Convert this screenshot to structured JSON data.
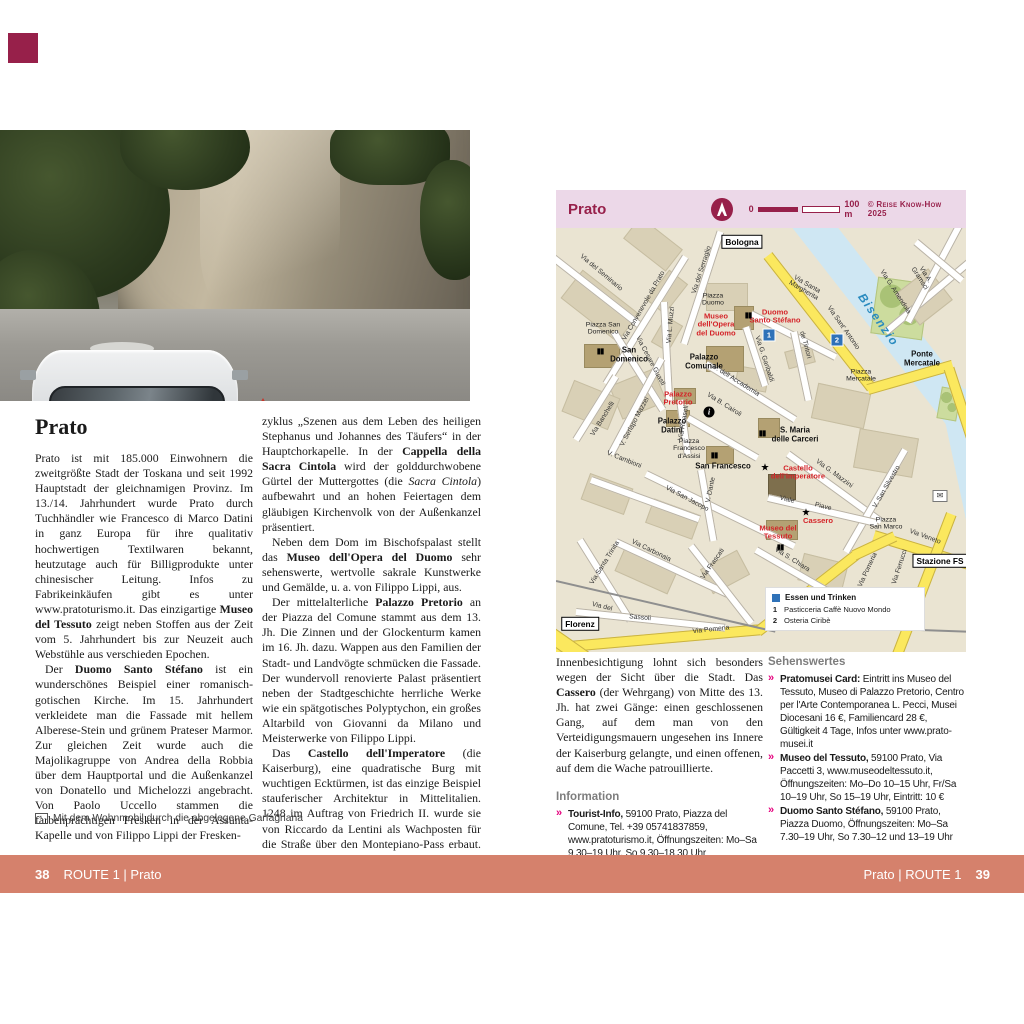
{
  "page_left": {
    "title": "Prato",
    "caption_icon_glyph": "↖",
    "caption": "Mit dem Wohnmobil durch die abgelegene Garfagnana",
    "photo": {
      "vehicle_brand": "HYMER"
    },
    "col1_p1": [
      {
        "t": "Prato ist mit 185.000 Einwohnern die zweitgrößte Stadt der Toskana und seit 1992 Hauptstadt der gleichnamigen Provinz. Im 13./14. Jahrhundert wurde Prato durch Tuchhändler wie Francesco di Marco Datini in ganz Europa für ihre qualitativ hochwertigen Textilwaren bekannt, heutzutage auch für Billigprodukte unter chinesischer Leitung. Infos zu Fabrikeinkäufen gibt es unter www.pratoturismo.it. Das einzigartige "
      },
      {
        "t": "Museo del Tessuto",
        "b": true
      },
      {
        "t": " zeigt neben Stoffen aus der Zeit vom 5. Jahrhundert bis zur Neuzeit auch Webstühle aus verschieden Epochen."
      }
    ],
    "col1_p2": [
      {
        "t": "Der "
      },
      {
        "t": "Duomo Santo Stéfano",
        "b": true
      },
      {
        "t": " ist ein wunderschönes Beispiel einer romanisch-gotischen Kirche. Im 15. Jahrhundert verkleidete man die Fassade mit hellem Alberese-Stein und grünem Prateser Marmor. Zur gleichen Zeit wurde auch die Majolikagruppe von Andrea della Robbia über dem Hauptportal und die Außenkanzel von Donatello und Michelozzi angebracht. Von Paolo Uccello stammen die farbenprächtigen Fresken in der Assunta-Kapelle und von Filippo Lippi der Fresken-"
      }
    ],
    "col2_p1": [
      {
        "t": "zyklus „Szenen aus dem Leben des heiligen Stephanus und Johannes des Täufers“ in der Hauptchorkapelle. In der "
      },
      {
        "t": "Cappella della Sacra Cintola",
        "b": true
      },
      {
        "t": " wird der golddurchwobene Gürtel der Muttergottes (die "
      },
      {
        "t": "Sacra Cintola",
        "i": true
      },
      {
        "t": ") aufbewahrt und an hohen Feiertagen dem gläubigen Kirchenvolk von der Außenkanzel präsentiert."
      }
    ],
    "col2_p2": [
      {
        "t": "Neben dem Dom im Bischofspalast stellt das "
      },
      {
        "t": "Museo dell'Opera del Duomo",
        "b": true
      },
      {
        "t": " sehr sehenswerte, wertvolle sakrale Kunstwerke und Gemälde, u. a. von Filippo Lippi, aus."
      }
    ],
    "col2_p3": [
      {
        "t": "Der mittelalterliche "
      },
      {
        "t": "Palazzo Pretorio",
        "b": true
      },
      {
        "t": " an der Piazza del Comune stammt aus dem 13. Jh. Die Zinnen und der Glockenturm kamen im 16. Jh. dazu. Wappen aus den Familien der Stadt- und Landvögte schmücken die Fassade. Der wundervoll renovierte Palast präsentiert neben der Stadtgeschichte herrliche Werke wie ein spätgotisches Polyptychon, ein großes Altarbild von Giovanni da Milano und Meisterwerke von Filippo Lippi."
      }
    ],
    "col2_p4": [
      {
        "t": "Das "
      },
      {
        "t": "Castello dell'Imperatore",
        "b": true
      },
      {
        "t": " (die Kaiserburg), eine quadratische Burg mit wuchtigen Ecktürmen, ist das einzige Beispiel stauferischer Architektur in Mittelitalien. 1248 im Auftrag von Friedrich II. wurde sie von Riccardo da Lentini als Wachposten für die Straße über den Montepiano-Pass erbaut. Eine"
      }
    ]
  },
  "map": {
    "header": {
      "title": "Prato",
      "scale_zero": "0",
      "scale_label": "100 m",
      "copyright": "© Reise Know-How 2025"
    },
    "legend": {
      "title": "Essen und Trinken",
      "items": [
        {
          "num": "1",
          "label": "Pasticceria Caffè Nuovo Mondo"
        },
        {
          "num": "2",
          "label": "Osteria Ciribè"
        }
      ]
    },
    "labels": [
      {
        "n": "street-via-del-seminario",
        "t": "Via del Seminario",
        "x": 45,
        "y": 45,
        "r": 40,
        "cls": "street"
      },
      {
        "n": "street-via-convenevole",
        "t": "Via Convenevole da Prato",
        "x": 88,
        "y": 78,
        "r": -60,
        "cls": "street"
      },
      {
        "n": "street-via-del-serraglio",
        "t": "Via del Serraglio",
        "x": 146,
        "y": 42,
        "r": -72,
        "cls": "street"
      },
      {
        "n": "sign-bologna",
        "t": "Bologna",
        "x": 186,
        "y": 14,
        "r": 0,
        "cls": "sign"
      },
      {
        "n": "place-piazza-duomo",
        "t": "Piazza\nDuomo",
        "x": 157,
        "y": 72,
        "r": 0,
        "cls": "place"
      },
      {
        "n": "poi-museo-opera-duomo",
        "t": "Museo\ndell'Opera\ndel Duomo",
        "x": 160,
        "y": 97,
        "r": 0,
        "cls": "poi-red"
      },
      {
        "n": "poi-duomo-santo-stefano",
        "t": "Duomo\nSanto Stéfano",
        "x": 219,
        "y": 89,
        "r": 0,
        "cls": "poi-red"
      },
      {
        "n": "church-icon-duomo",
        "t": "▮▮",
        "x": 192,
        "y": 88,
        "r": 0,
        "cls": "church"
      },
      {
        "n": "marker-1",
        "t": "1",
        "x": 213,
        "y": 107,
        "r": 0,
        "cls": "marker"
      },
      {
        "n": "street-via-santa-margherita",
        "t": "Via Santa\nMargherita",
        "x": 249,
        "y": 60,
        "r": 30,
        "cls": "street"
      },
      {
        "n": "street-via-sant-antonio",
        "t": "Via Sant' Antonio",
        "x": 287,
        "y": 100,
        "r": 55,
        "cls": "street"
      },
      {
        "n": "marker-2",
        "t": "2",
        "x": 281,
        "y": 112,
        "r": 0,
        "cls": "marker"
      },
      {
        "n": "river-bisenzio",
        "t": "Bisenzio",
        "x": 322,
        "y": 92,
        "r": 55,
        "cls": "river"
      },
      {
        "n": "street-via-g-amendola",
        "t": "Via G. Amendola",
        "x": 339,
        "y": 64,
        "r": 57,
        "cls": "street"
      },
      {
        "n": "street-via-a-gramsci",
        "t": "Via A. Gramsci",
        "x": 366,
        "y": 49,
        "r": 57,
        "cls": "street"
      },
      {
        "n": "poi-ponte-mercatale",
        "t": "Ponte\nMercatale",
        "x": 366,
        "y": 131,
        "r": 0,
        "cls": "poi-black"
      },
      {
        "n": "place-piazza-mercatale",
        "t": "Piazza\nMercatale",
        "x": 305,
        "y": 148,
        "r": 0,
        "cls": "place"
      },
      {
        "n": "street-de-tintori",
        "t": "de Tintori",
        "x": 249,
        "y": 117,
        "r": 75,
        "cls": "street"
      },
      {
        "n": "street-via-g-garibaldi",
        "t": "Via G. Garibaldi",
        "x": 208,
        "y": 131,
        "r": 72,
        "cls": "street"
      },
      {
        "n": "place-piazza-san-domenico",
        "t": "Piazza San\nDomenico",
        "x": 47,
        "y": 101,
        "r": 0,
        "cls": "place"
      },
      {
        "n": "poi-san-domenico",
        "t": "San\nDomenico",
        "x": 73,
        "y": 127,
        "r": 0,
        "cls": "poi-black"
      },
      {
        "n": "church-icon-san-domenico",
        "t": "▮▮",
        "x": 44,
        "y": 124,
        "r": 0,
        "cls": "church"
      },
      {
        "n": "poi-palazzo-comunale",
        "t": "Palazzo\nComunale",
        "x": 148,
        "y": 134,
        "r": 0,
        "cls": "poi-black"
      },
      {
        "n": "street-via-cesare-guasti",
        "t": "Via Cesare Guasti",
        "x": 94,
        "y": 133,
        "r": 62,
        "cls": "street"
      },
      {
        "n": "street-via-l-muzzi",
        "t": "Via L. Muzzi",
        "x": 115,
        "y": 97,
        "r": -85,
        "cls": "street"
      },
      {
        "n": "street-v-dell-accademia",
        "t": "V. dell Accademia",
        "x": 180,
        "y": 153,
        "r": 32,
        "cls": "street"
      },
      {
        "n": "street-via-b-cairoli",
        "t": "Via B. Cairoli",
        "x": 168,
        "y": 177,
        "r": 32,
        "cls": "street"
      },
      {
        "n": "tourist-info-icon",
        "t": "i",
        "x": 153,
        "y": 184,
        "r": 0,
        "cls": "info"
      },
      {
        "n": "poi-palazzo-pretorio",
        "t": "Palazzo\nPretorio",
        "x": 122,
        "y": 171,
        "r": 0,
        "cls": "poi-red"
      },
      {
        "n": "poi-palazzo-datini",
        "t": "Palazzo\nDatini",
        "x": 116,
        "y": 198,
        "r": 0,
        "cls": "poi-black"
      },
      {
        "n": "street-via-ricasoli",
        "t": "Via Ricasoli",
        "x": 128,
        "y": 195,
        "r": -80,
        "cls": "street"
      },
      {
        "n": "street-via-banchelli",
        "t": "Via Banchelli",
        "x": 47,
        "y": 191,
        "r": -58,
        "cls": "street"
      },
      {
        "n": "street-v-serlapo-mazzei",
        "t": "V. Serlapo Mazzei",
        "x": 79,
        "y": 194,
        "r": -62,
        "cls": "street"
      },
      {
        "n": "place-piazza-francesco-assisi",
        "t": "Piazza\nFrancesco\nd'Assisi",
        "x": 133,
        "y": 221,
        "r": 0,
        "cls": "place"
      },
      {
        "n": "poi-san-francesco",
        "t": "San Francesco",
        "x": 167,
        "y": 239,
        "r": 0,
        "cls": "poi-black"
      },
      {
        "n": "church-icon-san-francesco",
        "t": "▮▮",
        "x": 158,
        "y": 228,
        "r": 0,
        "cls": "church"
      },
      {
        "n": "street-v-cambioni",
        "t": "V. Cambioni",
        "x": 68,
        "y": 232,
        "r": 22,
        "cls": "street"
      },
      {
        "n": "street-via-san-jacopo",
        "t": "Via San Jacopo",
        "x": 131,
        "y": 271,
        "r": 28,
        "cls": "street"
      },
      {
        "n": "street-v-dante",
        "t": "V. Dante",
        "x": 155,
        "y": 262,
        "r": -78,
        "cls": "street"
      },
      {
        "n": "poi-s-maria-delle-carceri",
        "t": "S. Maria\ndelle Carceri",
        "x": 239,
        "y": 207,
        "r": 0,
        "cls": "poi-black"
      },
      {
        "n": "church-icon-s-maria",
        "t": "▮▮",
        "x": 206,
        "y": 206,
        "r": 0,
        "cls": "church"
      },
      {
        "n": "poi-castello-imperatore",
        "t": "Castello\ndell'Imperatore",
        "x": 242,
        "y": 245,
        "r": 0,
        "cls": "poi-red"
      },
      {
        "n": "star-castello",
        "t": "★",
        "x": 209,
        "y": 240,
        "r": 0,
        "cls": "star"
      },
      {
        "n": "street-via-g-mazzini",
        "t": "Via G. Mazzini",
        "x": 278,
        "y": 246,
        "r": 36,
        "cls": "street"
      },
      {
        "n": "street-v-san-silvestro",
        "t": "V. San Silvestro",
        "x": 331,
        "y": 259,
        "r": -60,
        "cls": "street"
      },
      {
        "n": "street-viale",
        "t": "Viale",
        "x": 231,
        "y": 272,
        "r": 14,
        "cls": "street"
      },
      {
        "n": "street-piave",
        "t": "Piave",
        "x": 267,
        "y": 279,
        "r": 14,
        "cls": "street"
      },
      {
        "n": "poi-cassero",
        "t": "Cassero",
        "x": 262,
        "y": 293,
        "r": 0,
        "cls": "poi-red"
      },
      {
        "n": "star-cassero",
        "t": "★",
        "x": 250,
        "y": 285,
        "r": 0,
        "cls": "star"
      },
      {
        "n": "poi-museo-del-tessuto",
        "t": "Museo del\nTessuto",
        "x": 222,
        "y": 305,
        "r": 0,
        "cls": "poi-red"
      },
      {
        "n": "museum-icon-tessuto",
        "t": "▮▮",
        "x": 224,
        "y": 320,
        "r": 0,
        "cls": "church"
      },
      {
        "n": "place-piazza-san-marco",
        "t": "Piazza\nSan Marco",
        "x": 330,
        "y": 296,
        "r": 0,
        "cls": "place"
      },
      {
        "n": "street-via-veneto",
        "t": "Via Veneto",
        "x": 369,
        "y": 309,
        "r": 20,
        "cls": "street"
      },
      {
        "n": "sign-stazione-fs",
        "t": "Stazione FS",
        "x": 384,
        "y": 333,
        "r": 0,
        "cls": "sign"
      },
      {
        "n": "street-via-s-chiara",
        "t": "Via S. Chiara",
        "x": 236,
        "y": 332,
        "r": 32,
        "cls": "street"
      },
      {
        "n": "street-via-pomeria-right",
        "t": "Via Pomeria",
        "x": 312,
        "y": 342,
        "r": -65,
        "cls": "street"
      },
      {
        "n": "street-via-ferrucci",
        "t": "Via Ferrucci",
        "x": 344,
        "y": 339,
        "r": -72,
        "cls": "street"
      },
      {
        "n": "street-via-santa-trinita",
        "t": "Via Santa Trinita",
        "x": 49,
        "y": 335,
        "r": -58,
        "cls": "street"
      },
      {
        "n": "street-via-carbonaia",
        "t": "Via Carbonaia",
        "x": 95,
        "y": 323,
        "r": 26,
        "cls": "street"
      },
      {
        "n": "street-via-frascati",
        "t": "Via Frascati",
        "x": 157,
        "y": 336,
        "r": -55,
        "cls": "street"
      },
      {
        "n": "street-via-del",
        "t": "Via del",
        "x": 46,
        "y": 379,
        "r": 14,
        "cls": "street"
      },
      {
        "n": "street-sassoli",
        "t": "Sassoli",
        "x": 84,
        "y": 390,
        "r": 5,
        "cls": "street"
      },
      {
        "n": "sign-florenz",
        "t": "Florenz",
        "x": 24,
        "y": 396,
        "r": 0,
        "cls": "sign"
      },
      {
        "n": "street-via-pomeria-bottom",
        "t": "Via Pomeria",
        "x": 155,
        "y": 402,
        "r": -6,
        "cls": "street"
      },
      {
        "n": "post-office-icon",
        "t": "✉",
        "x": 384,
        "y": 268,
        "r": 0,
        "cls": "post"
      }
    ]
  },
  "page_right": {
    "intro": [
      {
        "t": "Innenbesichtigung lohnt sich besonders wegen der Sicht über die Stadt. Das "
      },
      {
        "t": "Cassero",
        "b": true
      },
      {
        "t": " (der Wehrgang) von Mitte des 13. Jh. hat zwei Gänge: einen geschlossenen Gang, auf dem man von den Verteidigungsmauern ungesehen ins Innere der Kaiserburg gelangte, und einen offenen, auf dem die Wache patrouillierte."
      }
    ],
    "information": {
      "heading": "Information",
      "entry1": [
        {
          "t": "Tourist-Info,",
          "b": true
        },
        {
          "t": " 59100 Prato, Piazza del Comune, Tel. +39 05741837859, www.pratoturismo.it, Öffnungszeiten: Mo–Sa 9.30–19 Uhr, So 9.30–18.30 Uhr"
        }
      ]
    },
    "sehenswertes": {
      "heading": "Sehenswertes",
      "entry1": [
        {
          "t": "Pratomusei Card:",
          "b": true
        },
        {
          "t": " Eintritt ins Museo del Tessuto, Museo di Palazzo Pretorio, Centro per l'Arte Contemporanea L. Pecci, Musei Diocesani 16 €, Familiencard 28 €, Gültigkeit 4 Tage, Infos unter www.prato-musei.it"
        }
      ],
      "entry2": [
        {
          "t": "Museo del Tessuto,",
          "b": true
        },
        {
          "t": " 59100 Prato, Via Paccetti 3, www.museodeltessuto.it, Öffnungszeiten: Mo–Do 10–15 Uhr, Fr/Sa 10–19 Uhr, So 15–19 Uhr, Eintritt: 10 €"
        }
      ],
      "entry3": [
        {
          "t": "Duomo Santo Stéfano,",
          "b": true
        },
        {
          "t": " 59100 Prato, Piazza Duomo, Öffnungszeiten: Mo–Sa 7.30–19 Uhr, So 7.30–12 und 13–19 Uhr"
        }
      ]
    }
  },
  "footer": {
    "left_page_number": "38",
    "left_label": "ROUTE 1 | Prato",
    "right_label": "Prato | ROUTE 1",
    "right_page_number": "39"
  },
  "colors": {
    "maroon": "#97204a",
    "footer_band": "#d5816c",
    "map_band_pink": "#ecd8e8",
    "poi_red": "#d42328",
    "chevron_pink": "#e5007d"
  }
}
